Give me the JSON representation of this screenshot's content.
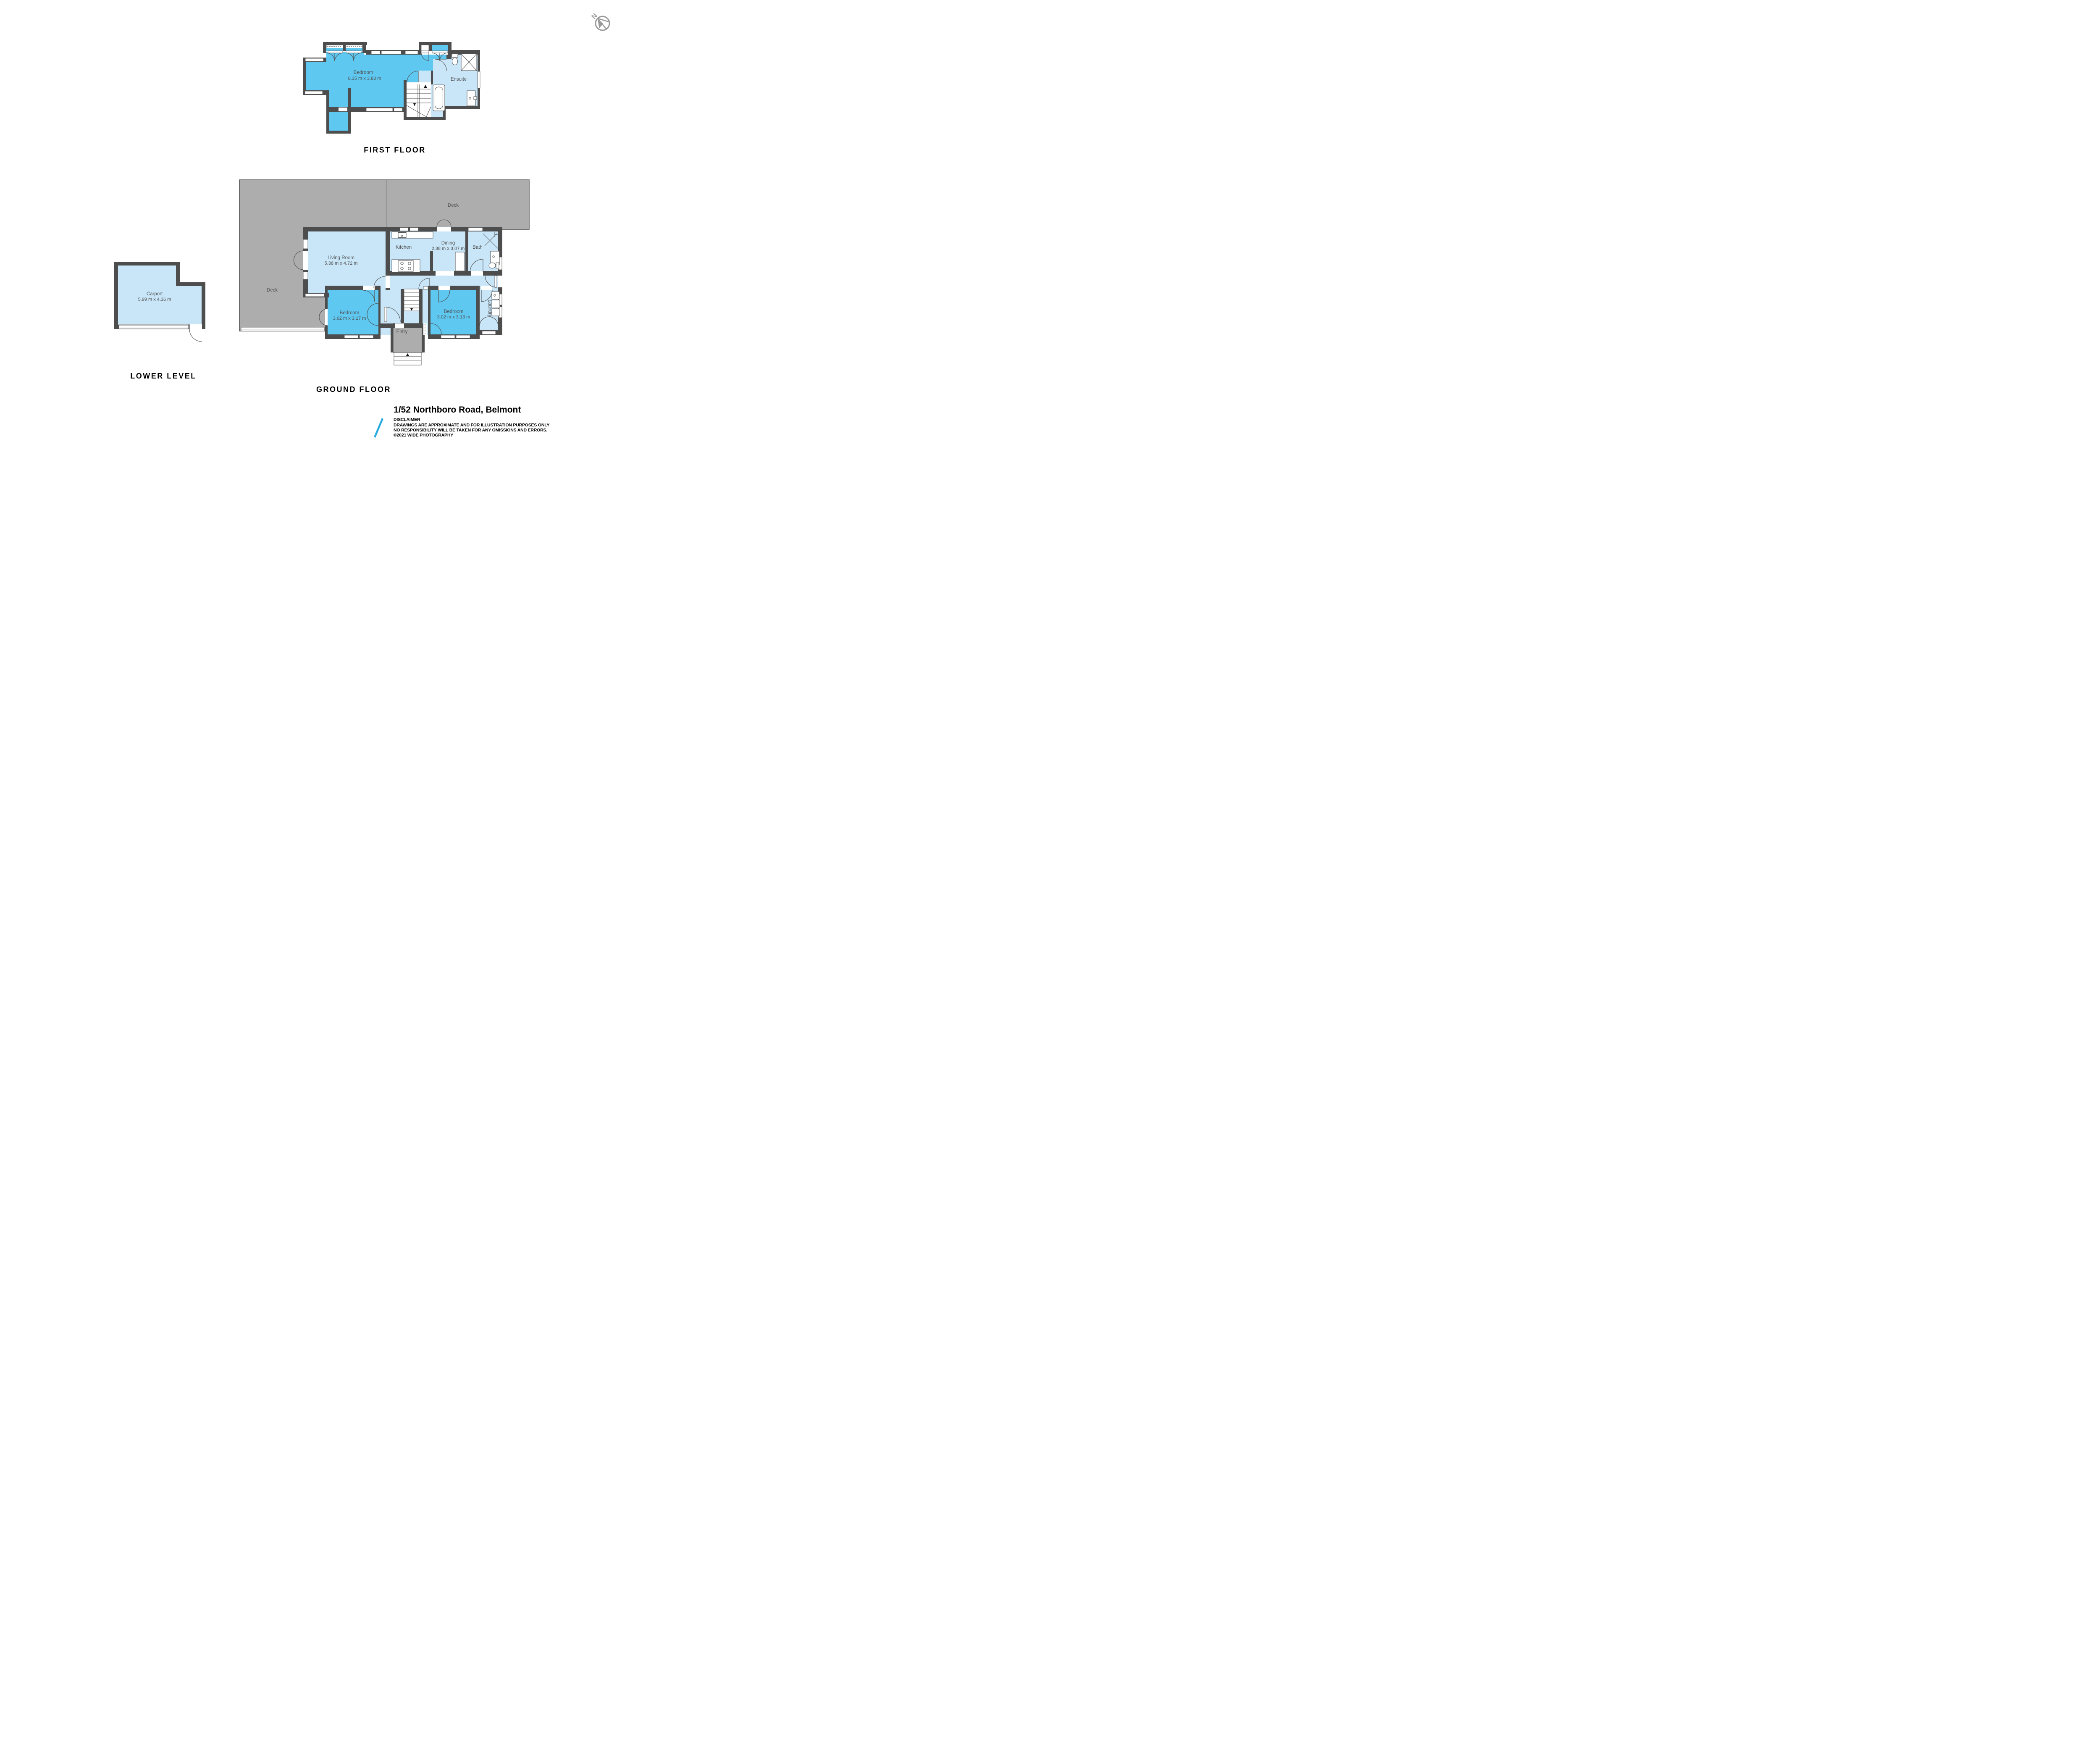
{
  "compass": {
    "label": "N"
  },
  "floors": {
    "first": {
      "title": "FIRST FLOOR",
      "rooms": {
        "bedroom": {
          "name": "Bedroom",
          "dims": "8.35 m x 3.83 m"
        },
        "ensuite": {
          "name": "Ensuite"
        }
      }
    },
    "ground": {
      "title": "GROUND FLOOR",
      "rooms": {
        "deck_top": {
          "name": "Deck"
        },
        "deck_left": {
          "name": "Deck"
        },
        "living": {
          "name": "Living Room",
          "dims": "5.38 m x 4.72 m"
        },
        "kitchen": {
          "name": "Kitchen"
        },
        "dining": {
          "name": "Dining",
          "dims": "2.38 m x 3.07 m"
        },
        "bath": {
          "name": "Bath"
        },
        "bedroom_left": {
          "name": "Bedroom",
          "dims": "3.62 m x 3.17 m"
        },
        "bedroom_right": {
          "name": "Bedroom",
          "dims": "3.02 m x 3.13 m"
        },
        "laundry": {
          "name": "Laundry"
        },
        "entry": {
          "name": "Entry"
        }
      }
    },
    "lower": {
      "title": "LOWER LEVEL",
      "rooms": {
        "carport": {
          "name": "Carport",
          "dims": "5.99 m x 4.36 m"
        }
      }
    }
  },
  "footer": {
    "address": "1/52 Northboro Road, Belmont",
    "disclaimer_title": "DISCLAIMER",
    "disclaimer_line1": "DRAWINGS ARE APPROXIMATE AND FOR ILLUSTRATION PURPOSES ONLY",
    "disclaimer_line2": "NO RESPONSIBILITY WILL BE TAKEN FOR ANY OMISSIONS AND ERRORS.",
    "copyright": "©2021 WIDE PHOTOGRAPHY"
  },
  "colors": {
    "wall": "#4D4D4D",
    "room_light": "#C9E6F8",
    "room_medium": "#5EC8F1",
    "deck_gray": "#ADADAD",
    "accent_blue": "#29ABE2",
    "compass_gray": "#9A9A9A",
    "label_text": "#4F4F4F"
  }
}
